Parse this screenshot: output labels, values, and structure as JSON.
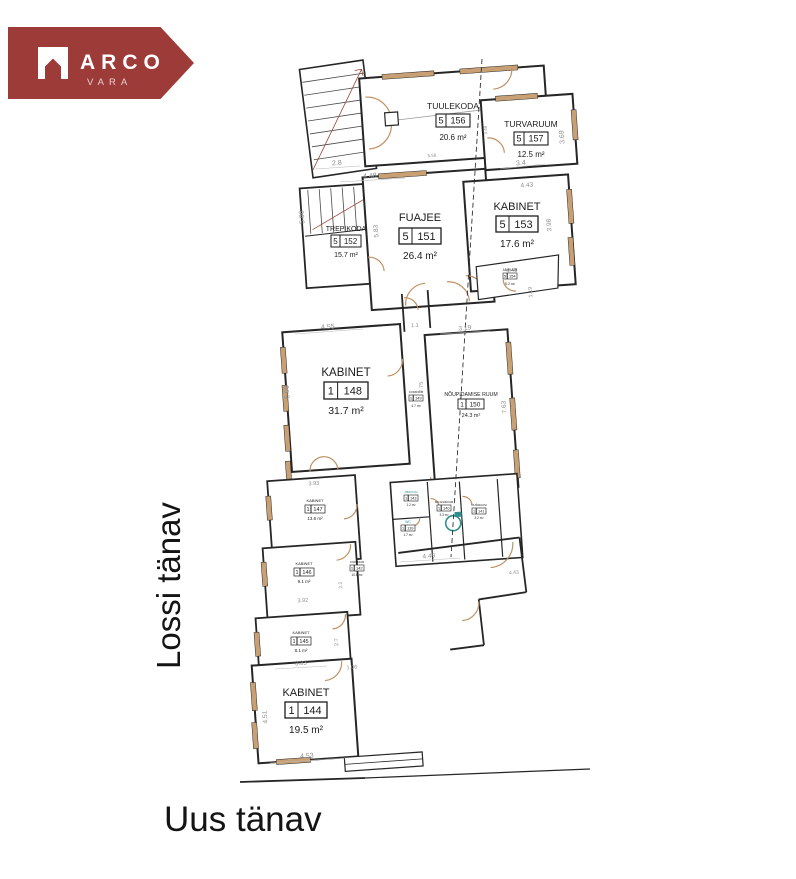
{
  "logo": {
    "brand": "ARCO",
    "sub": "VARA",
    "bg_color": "#9d3b38"
  },
  "streets": {
    "left": "Lossi tänav",
    "bottom": "Uus tänav"
  },
  "rooms": [
    {
      "name": "TUULEKODA",
      "unit": "5",
      "num": "156",
      "area": "20.6 m²"
    },
    {
      "name": "TURVARUUM",
      "unit": "5",
      "num": "157",
      "area": "12.5 m²"
    },
    {
      "name": "FUAJEE",
      "unit": "5",
      "num": "151",
      "area": "26.4 m²"
    },
    {
      "name": "TREPIKODA",
      "unit": "5",
      "num": "152",
      "area": "15.7 m²"
    },
    {
      "name": "KABINET",
      "unit": "5",
      "num": "153",
      "area": "17.6 m²"
    },
    {
      "name": "ABIRUUM",
      "unit": "5",
      "num": "154",
      "area": "5.2 m²"
    },
    {
      "name": "KABINET",
      "unit": "1",
      "num": "148",
      "area": "31.7 m²"
    },
    {
      "name": "KORIDOR",
      "unit": "1",
      "num": "149",
      "area": "4.7 m²"
    },
    {
      "name": "NÕUPIDAMISE RUUM",
      "unit": "1",
      "num": "150",
      "area": "24.3 m²"
    },
    {
      "name": "KABINET",
      "unit": "1",
      "num": "147",
      "area": "13.6 m²"
    },
    {
      "name": "ABIRUUM",
      "unit": "1",
      "num": "143",
      "area": "1.2 m²"
    },
    {
      "name": "WC-ESIRUUM",
      "unit": "1",
      "num": "140",
      "area": "3.3 m²"
    },
    {
      "name": "DUŠIRUUM",
      "unit": "1",
      "num": "141",
      "area": "3.2 m²"
    },
    {
      "name": "WC",
      "unit": "1",
      "num": "139",
      "area": "1.7 m²"
    },
    {
      "name": "KORIDOR",
      "unit": "1",
      "num": "142",
      "area": "10.6 m²"
    },
    {
      "name": "KABINET",
      "unit": "1",
      "num": "146",
      "area": "9.1 m²"
    },
    {
      "name": "KABINET",
      "unit": "1",
      "num": "145",
      "area": "8.1 m²"
    },
    {
      "name": "KABINET",
      "unit": "1",
      "num": "144",
      "area": "19.5 m²"
    }
  ],
  "dims": [
    "2.8",
    "4.48",
    "5.58",
    "3.48",
    "3.4",
    "3.69",
    "4.43",
    "5.96",
    "5.83",
    "3.98",
    "4.43",
    "1.19",
    "4.55",
    "1.1",
    "3.19",
    "6.98",
    "7.75",
    "7.63",
    "3.93",
    "4.49",
    "4.43",
    "3.92",
    "2.2",
    "2.7",
    "3.33",
    "1.06",
    "4.51",
    "4.53"
  ]
}
